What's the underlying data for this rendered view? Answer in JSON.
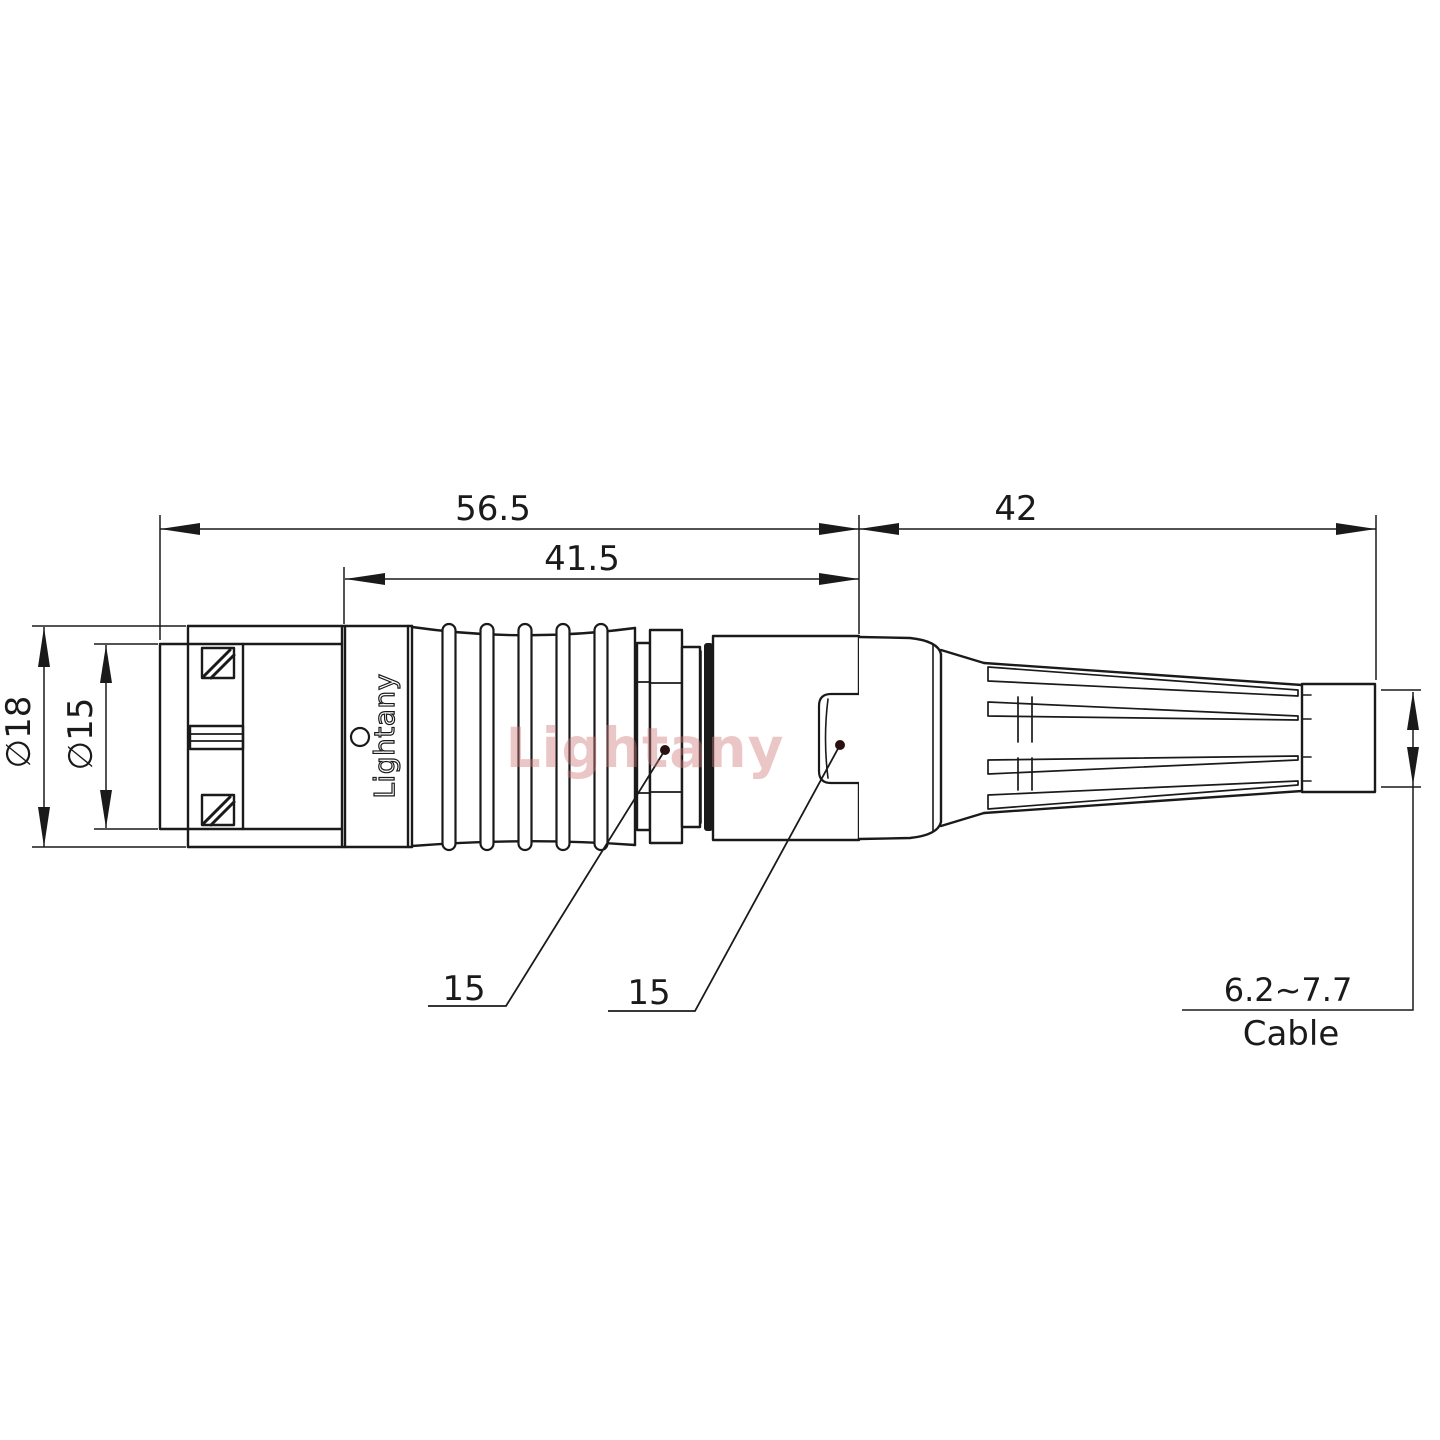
{
  "dimensions": {
    "overall_length": "56.5",
    "front_length": "41.5",
    "boot_length": "42",
    "outer_diameter": "∅18",
    "front_diameter": "∅15",
    "nut_callout": "15",
    "shell_callout": "15",
    "cable_range": "6.2~7.7",
    "cable_label": "Cable"
  },
  "branding": {
    "body_marking": "Lightany",
    "watermark": "Lightany"
  },
  "colors": {
    "line": "#1a1a1a",
    "watermark": "#d07878",
    "callout_dot": "#2a1010"
  }
}
